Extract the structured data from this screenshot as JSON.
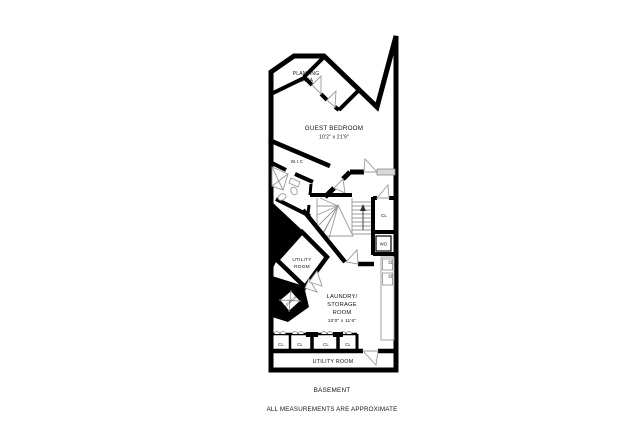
{
  "meta": {
    "drawing_type": "residential floor plan",
    "floor": "BASEMENT"
  },
  "colors": {
    "wall": "#000000",
    "fixture_line": "#999999",
    "window_fill": "#d9d9d9",
    "background": "#ffffff",
    "text": "#141414"
  },
  "rooms": {
    "planting_area": {
      "line1": "PLANTING",
      "line2": "AREA"
    },
    "guest_bedroom": {
      "name": "GUEST BEDROOM",
      "dims": "10'2\" x 21'9\""
    },
    "wic": {
      "name": "W.I.C"
    },
    "closet_right": {
      "name": "CL"
    },
    "washer_dryer": {
      "name": "WD"
    },
    "utility_room_mid": {
      "line1": "UTILITY",
      "line2": "ROOM"
    },
    "elevator": {
      "name": "ELEVATOR"
    },
    "laundry_storage": {
      "line1": "LAUNDRY/",
      "line2": "STORAGE",
      "line3": "ROOM",
      "dims": "10'0\" x 11'6\""
    },
    "closet_row": {
      "labels": [
        "CL",
        "CL",
        "CL",
        "CL"
      ]
    },
    "utility_room_bottom": {
      "name": "UTILITY ROOM"
    }
  },
  "footer": {
    "floor_label": "BASEMENT",
    "disclaimer": "ALL MEASUREMENTS ARE APPROXIMATE"
  }
}
